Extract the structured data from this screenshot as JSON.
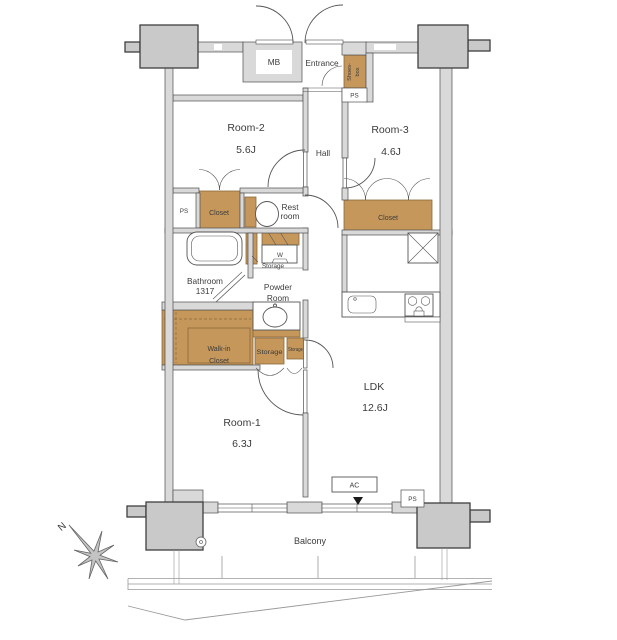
{
  "plan": {
    "rooms": {
      "room2": {
        "name": "Room-2",
        "area": "5.6J"
      },
      "room3": {
        "name": "Room-3",
        "area": "4.6J"
      },
      "room1": {
        "name": "Room-1",
        "area": "6.3J"
      },
      "ldk": {
        "name": "LDK",
        "area": "12.6J"
      },
      "hall": {
        "name": "Hall"
      },
      "entrance": {
        "name": "Entrance"
      },
      "restroom": {
        "line1": "Rest",
        "line2": "room"
      },
      "bathroom": {
        "name": "Bathroom",
        "size": "1317"
      },
      "powder_room": {
        "line1": "Powder",
        "line2": "Room"
      },
      "balcony": {
        "name": "Balcony"
      }
    },
    "storage": {
      "closet_room2": {
        "label": "Closet"
      },
      "closet_room3": {
        "label": "Closet"
      },
      "walk_in_closet": {
        "line1": "Walk-in",
        "line2": "Closet"
      },
      "shoes_box": {
        "line1": "Shoes-",
        "line2": "box"
      },
      "storage_hall": {
        "label": "Storage"
      },
      "storage_a": {
        "label": "Storage"
      },
      "storage_b": {
        "label": "Storage"
      },
      "meter_box": {
        "label": "MB"
      },
      "washer": {
        "label": "W"
      }
    },
    "utility": {
      "ps_entrance": "PS",
      "ps_left": "PS",
      "ps_bottom": "PS",
      "ac": "AC"
    },
    "compass": {
      "label": "N"
    },
    "colors": {
      "closet_fill": "#c5975b",
      "closet_edge": "#8a6a3b",
      "wall_fill": "#d9d9d9",
      "wall_edge": "#4f4f4f",
      "column_fill": "#c9c9c9",
      "column_edge": "#3f3f3f",
      "line": "#555555",
      "text_color": "#3c3c3c"
    }
  }
}
